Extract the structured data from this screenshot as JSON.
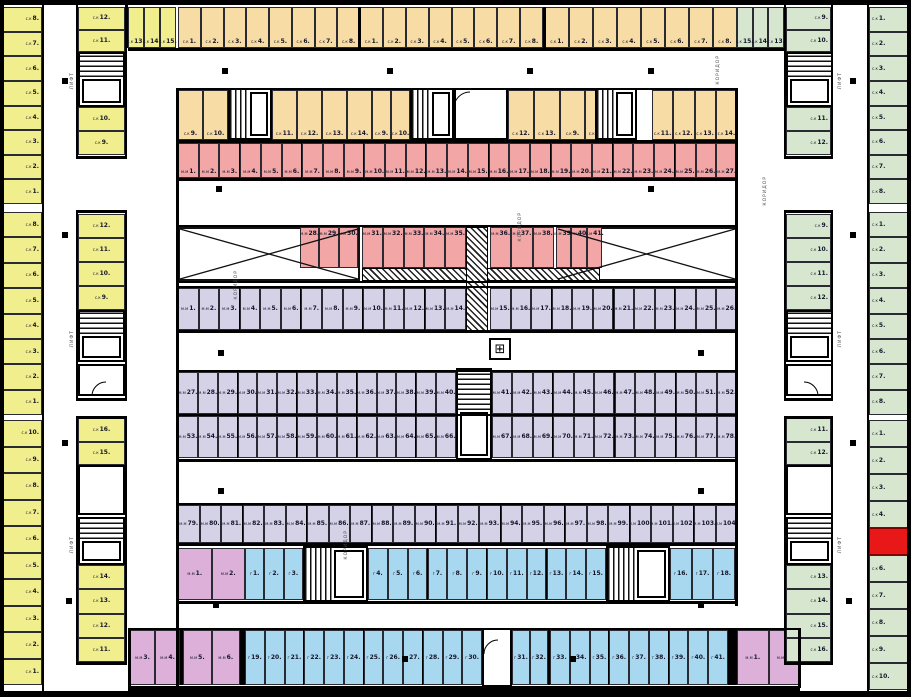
{
  "plan_title": "Underground parking / storage floor plan",
  "colors": {
    "yellow": "#f1ee8e",
    "orange": "#f7dca6",
    "red": "#f2a6a6",
    "purple": "#d5d2e8",
    "blue": "#a8d8f0",
    "green": "#d7e7cf",
    "pink": "#dcb0d8",
    "highlight": "#e81818"
  },
  "symbols": {
    "corridor": "КОРИДОР",
    "lift": "ЛИФТ",
    "compass": "⊞"
  },
  "zones": {
    "left_outer_storage": {
      "prefix": "с.к",
      "sections": [
        [
          "8",
          "7",
          "6",
          "5",
          "4",
          "3",
          "2",
          "1"
        ],
        [
          "8",
          "7",
          "6",
          "5",
          "4",
          "3",
          "2",
          "1"
        ],
        [
          "10",
          "9",
          "8",
          "7",
          "6",
          "5",
          "4",
          "3",
          "2",
          "1"
        ]
      ]
    },
    "left_inner_storage": {
      "prefix": "с.к",
      "segments": [
        [
          "12",
          "11"
        ],
        [
          "10",
          "9"
        ],
        [
          "12",
          "11",
          "10",
          "9"
        ],
        [
          "16",
          "15"
        ],
        [
          "14",
          "13",
          "12",
          "11"
        ]
      ]
    },
    "top_row_outer": {
      "prefix": "с.к",
      "yellow": [
        "13",
        "14",
        "15"
      ],
      "orange_groups": [
        [
          "1",
          "2",
          "3",
          "4",
          "5",
          "6",
          "7",
          "8"
        ],
        [
          "1",
          "2",
          "3",
          "4",
          "5",
          "6",
          "7",
          "8"
        ],
        [
          "1",
          "2",
          "3",
          "4",
          "5",
          "6",
          "7",
          "8"
        ]
      ],
      "green": [
        "15",
        "14",
        "13"
      ]
    },
    "top_row_inner": {
      "prefix": "с.к",
      "segments": [
        [
          "9",
          "10"
        ],
        [
          "11",
          "12",
          "13",
          "14"
        ],
        [
          "9",
          "10"
        ],
        [
          "12",
          "13"
        ],
        [
          "9",
          "10"
        ],
        [
          "11",
          "12",
          "13",
          "14"
        ]
      ]
    },
    "red_parking": {
      "prefix": "м.м",
      "row_upper": [
        "1",
        "2",
        "3",
        "4",
        "5",
        "6",
        "7",
        "8",
        "9",
        "10",
        "11",
        "12",
        "13",
        "14",
        "15",
        "16",
        "17",
        "18",
        "19",
        "20",
        "21",
        "22",
        "23",
        "24",
        "25",
        "26",
        "27"
      ],
      "row_mid_segments": [
        [
          "28",
          "29",
          "30"
        ],
        [
          "31",
          "32",
          "33",
          "34",
          "35"
        ],
        [
          "36",
          "37",
          "38"
        ],
        [
          "39",
          "40",
          "41"
        ]
      ]
    },
    "purple_parking": {
      "prefix": "м.м",
      "row1_segments": [
        [
          "1",
          "2",
          "3",
          "4",
          "5",
          "6",
          "7",
          "8",
          "9",
          "10",
          "11",
          "12",
          "13",
          "14"
        ],
        [
          "15",
          "16",
          "17",
          "18",
          "19",
          "20",
          "21",
          "22",
          "23",
          "24",
          "25",
          "26"
        ]
      ],
      "row2_top_segments": [
        [
          "27",
          "28",
          "29",
          "30",
          "31",
          "32",
          "33",
          "34",
          "35",
          "36",
          "37",
          "38",
          "39",
          "40"
        ],
        [
          "41",
          "42",
          "43",
          "44",
          "45",
          "46",
          "47",
          "48",
          "49",
          "50",
          "51",
          "52"
        ]
      ],
      "row2_bottom_segments": [
        [
          "53",
          "54",
          "55",
          "56",
          "57",
          "58",
          "59",
          "60",
          "61",
          "62",
          "63",
          "64",
          "65",
          "66"
        ],
        [
          "67",
          "68",
          "69",
          "70",
          "71",
          "72",
          "73",
          "74",
          "75",
          "76",
          "77",
          "78"
        ]
      ],
      "row3": [
        "79",
        "80",
        "81",
        "82",
        "83",
        "84",
        "85",
        "86",
        "87",
        "88",
        "89",
        "90",
        "91",
        "92",
        "93",
        "94",
        "95",
        "96",
        "97",
        "98",
        "99",
        "100",
        "101",
        "102",
        "103",
        "104"
      ]
    },
    "blue_garages": {
      "prefix": "г",
      "row1_segments": [
        [
          "1",
          "2",
          "3"
        ],
        [
          "4",
          "5",
          "6",
          "7",
          "8",
          "9",
          "10",
          "11",
          "12",
          "13",
          "14",
          "15"
        ],
        [
          "16",
          "17",
          "18"
        ]
      ],
      "row2_segments": [
        [
          "19",
          "20",
          "21",
          "22",
          "23",
          "24",
          "25",
          "26",
          "27",
          "28",
          "29",
          "30"
        ],
        [
          "31",
          "32"
        ],
        [
          "33",
          "34",
          "35",
          "36",
          "37",
          "38",
          "39",
          "40",
          "41"
        ]
      ]
    },
    "pink_parking": {
      "prefix": "м.м",
      "upper_left": [
        "1",
        "2"
      ],
      "lower_left": [
        [
          "3",
          "4"
        ],
        [
          "5",
          "6"
        ]
      ],
      "lower_right": [
        "1",
        "2"
      ]
    },
    "right_inner_storage": {
      "prefix": "с.к",
      "segments": [
        [
          "9",
          "10"
        ],
        [
          "11",
          "12"
        ],
        [
          "9",
          "10",
          "11",
          "12"
        ],
        [
          "11",
          "12"
        ],
        [
          "13",
          "14",
          "15",
          "16"
        ]
      ]
    },
    "right_outer_storage": {
      "prefix": "с.к",
      "sections": [
        [
          "1",
          "2",
          "3",
          "4",
          "5",
          "6",
          "7",
          "8"
        ],
        [
          "1",
          "2",
          "3",
          "4",
          "5",
          "6",
          "7",
          "8"
        ],
        [
          "1",
          "2",
          "3",
          "4"
        ],
        [
          "6",
          "7",
          "8",
          "9",
          "10"
        ]
      ],
      "highlighted_position": "5"
    }
  }
}
